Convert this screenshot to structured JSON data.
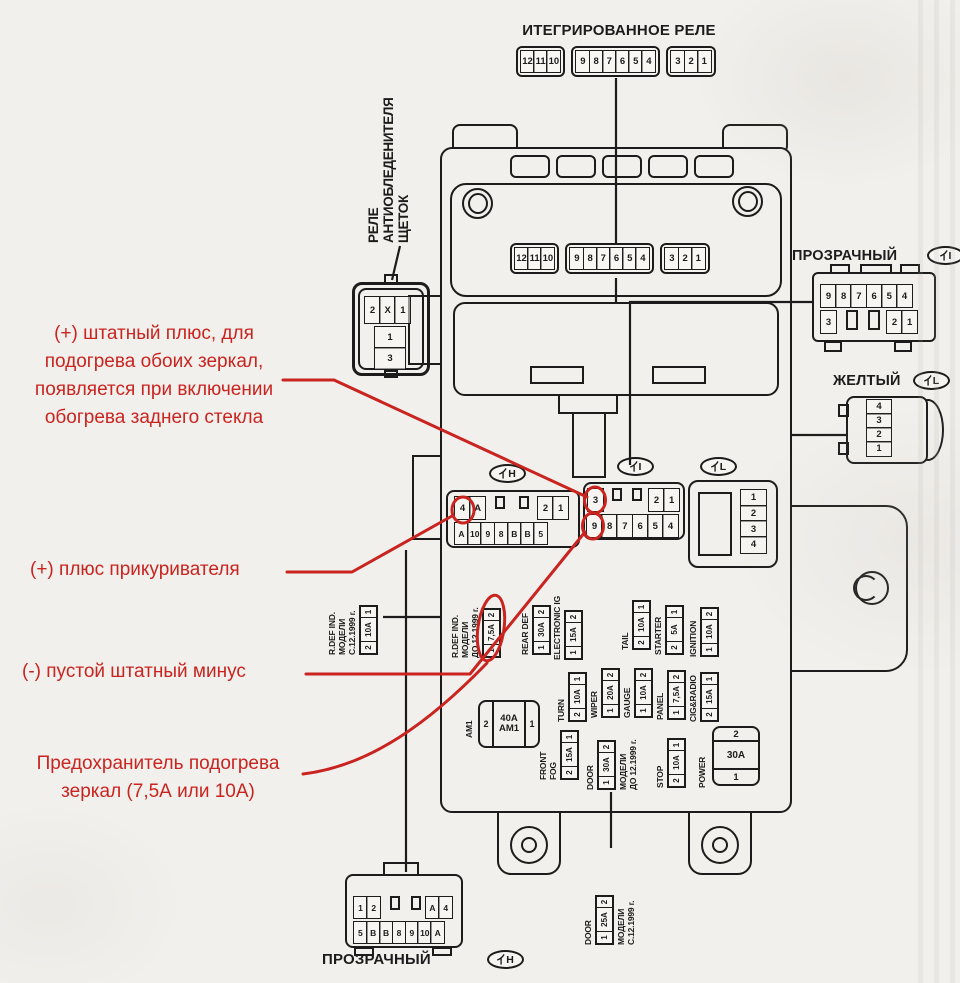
{
  "palette": {
    "paper": "#f2f0ec",
    "ink": "#1c1c1c",
    "red": "#c92420"
  },
  "top_relay": {
    "label": "ИТЕГРИРОВАННОЕ РЕЛЕ",
    "g1": [
      "12",
      "11",
      "10"
    ],
    "g2": [
      "9",
      "8",
      "7",
      "6",
      "5",
      "4"
    ],
    "g3": [
      "3",
      "2",
      "1"
    ]
  },
  "inner_conn": {
    "g1": [
      "12",
      "11",
      "10"
    ],
    "g2": [
      "9",
      "8",
      "7",
      "6",
      "5",
      "4"
    ],
    "g3": [
      "3",
      "2",
      "1"
    ]
  },
  "left_relay": {
    "label": "РЕЛЕ\nАНТИОБЛЕДЕНИТЕЛЯ\nЩЕТОК",
    "row1": [
      "2",
      "X",
      "1"
    ],
    "stack": [
      "1",
      "3"
    ]
  },
  "tags": {
    "h": "H",
    "i": "I",
    "l": "L"
  },
  "conn_h": {
    "row1_left": [
      "4",
      "A"
    ],
    "row1_right": [
      "2",
      "1"
    ],
    "row2": [
      "A",
      "10",
      "9",
      "8",
      "B",
      "B",
      "5"
    ]
  },
  "conn_i": {
    "row1_left": [
      "3"
    ],
    "row1_right": [
      "2",
      "1"
    ],
    "row2": [
      "9",
      "8",
      "7",
      "6",
      "5",
      "4"
    ]
  },
  "conn_l": {
    "cells": [
      "1",
      "2",
      "3",
      "4"
    ]
  },
  "right_clear": {
    "label": "ПРОЗРАЧНЫЙ",
    "row1": [
      "9",
      "8",
      "7",
      "6",
      "5",
      "4"
    ],
    "row2_left": [
      "3"
    ],
    "row2_right": [
      "2",
      "1"
    ]
  },
  "yellow": {
    "label": "ЖЕЛТЫЙ",
    "cells": [
      "4",
      "3",
      "2",
      "1"
    ]
  },
  "bottom_clear": {
    "label": "ПРОЗРАЧНЫЙ",
    "row1_left": [
      "1",
      "2"
    ],
    "row1_right": [
      "A",
      "4"
    ],
    "row2": [
      "5",
      "B",
      "B",
      "8",
      "9",
      "10",
      "A"
    ]
  },
  "annotations": {
    "a1": "(+) штатный плюс, для\nподогрева обоих зеркал,\nпоявляется при включении\nобогрева заднего стекла",
    "a2": "(+) плюс прикуривателя",
    "a3": "(-) пустой штатный минус",
    "a4": "Предохранитель подогрева\nзеркал (7,5А или 10А)"
  },
  "fuses": {
    "rdef_out": {
      "label": "R.DEF IND.\nМОДЕЛИ\nC.12.1999 г.",
      "cells": [
        "2",
        "10A",
        "1"
      ]
    },
    "rdef_in": {
      "label": "R.DEF IND.\nМОДЕЛИ\nДО 12.1999 г.",
      "cells": [
        "1",
        "7,5A",
        "2"
      ]
    },
    "rear_def": {
      "label": "REAR DEF",
      "cells": [
        "1",
        "30A",
        "2"
      ]
    },
    "electronic_ig": {
      "label": "ELECTRONIC IG",
      "cells": [
        "1",
        "15A",
        "2"
      ]
    },
    "tail": {
      "label": "TAIL",
      "cells": [
        "2",
        "10A",
        "1"
      ]
    },
    "starter": {
      "label": "STARTER",
      "cells": [
        "2",
        "5A",
        "1"
      ]
    },
    "ignition": {
      "label": "IGNITION",
      "cells": [
        "1",
        "10A",
        "2"
      ]
    },
    "turn": {
      "label": "TURN",
      "cells": [
        "2",
        "10A",
        "1"
      ]
    },
    "wiper": {
      "label": "WIPER",
      "cells": [
        "1",
        "20A",
        "2"
      ]
    },
    "gauge": {
      "label": "GAUGE",
      "cells": [
        "1",
        "10A",
        "2"
      ]
    },
    "panel": {
      "label": "PANEL",
      "cells": [
        "1",
        "7,5A",
        "2"
      ]
    },
    "cig_radio": {
      "label": "CIG&RADIO",
      "cells": [
        "2",
        "15A",
        "1"
      ]
    },
    "front_fog": {
      "label": "FRONT\nFOG",
      "cells": [
        "2",
        "15A",
        "1"
      ]
    },
    "door_early": {
      "label": "DOOR",
      "note": "МОДЕЛИ\nДО 12.1999 г.",
      "cells": [
        "1",
        "30A",
        "2"
      ]
    },
    "stop": {
      "label": "STOP",
      "cells": [
        "2",
        "10A",
        "1"
      ]
    },
    "door_late": {
      "label": "DOOR",
      "note": "МОДЕЛИ\nC.12.1999 г.",
      "cells": [
        "1",
        "25A",
        "2"
      ]
    },
    "am1": {
      "label": "AM1",
      "cell_left": "2",
      "cell_mid": "40A\nAM1",
      "cell_right": "1"
    },
    "power": {
      "label": "POWER",
      "cell_top": "2",
      "cell_mid": "30A",
      "cell_bottom": "1"
    }
  }
}
